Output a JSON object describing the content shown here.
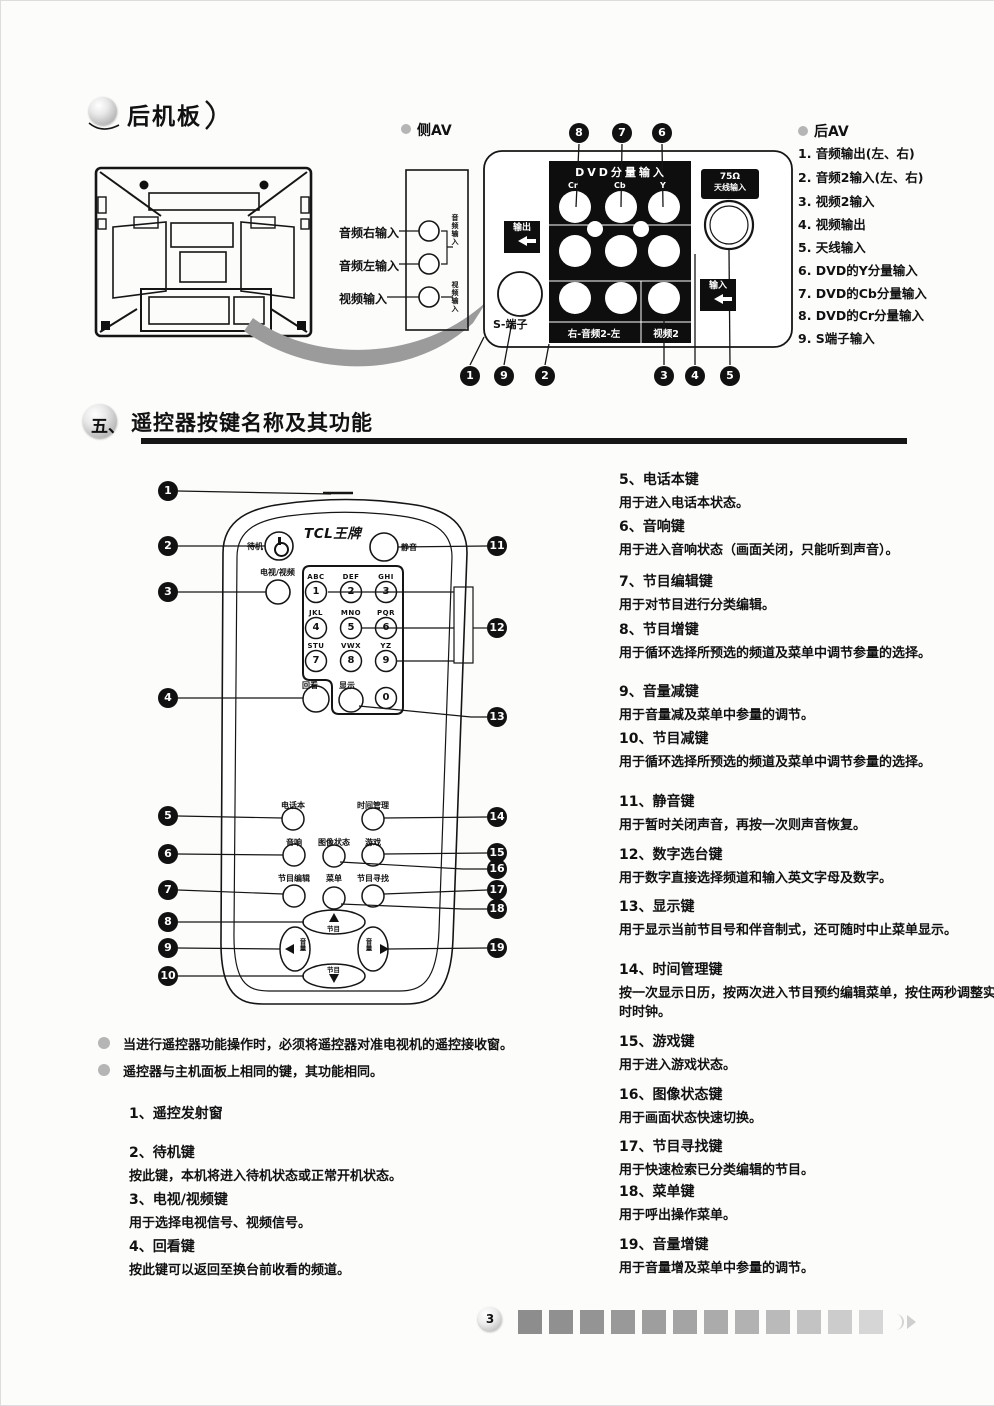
{
  "page": {
    "number": "3"
  },
  "rear": {
    "title": "后机板",
    "side_av_label": "侧AV",
    "side_jacks": [
      "音频右输入",
      "音频左输入",
      "视频输入"
    ],
    "side_vertical": [
      "音频输入",
      "视频输入"
    ],
    "dvd_header": "DVD分量输入",
    "dvd_cols": [
      "Cr",
      "Cb",
      "Y"
    ],
    "out_tag": "输出",
    "in_tag": "输入",
    "ant_tag_line1": "75Ω",
    "ant_tag_line2": "天线输入",
    "s_label": "S-端子",
    "audio2_label": "右-音频2-左",
    "video2_label": "视频2",
    "callouts_top": [
      "8",
      "7",
      "6"
    ],
    "callouts_bottom": [
      "1",
      "9",
      "2",
      "3",
      "4",
      "5"
    ],
    "av_label": "后AV",
    "av_items": [
      "1. 音频输出(左、右)",
      "2. 音频2输入(左、右)",
      "3. 视频2输入",
      "4. 视频输出",
      "5. 天线输入",
      "6. DVD的Y分量输入",
      "7. DVD的Cb分量输入",
      "8. DVD的Cr分量输入",
      "9. S端子输入"
    ]
  },
  "remote": {
    "section_no": "五、",
    "section_title": "遥控器按键名称及其功能",
    "brand": "TCL王牌",
    "power": "待机",
    "mute": "静音",
    "tv_video": "电视/视频",
    "keys": [
      {
        "l": "ABC",
        "d": "1"
      },
      {
        "l": "DEF",
        "d": "2"
      },
      {
        "l": "GHI",
        "d": "3"
      },
      {
        "l": "JKL",
        "d": "4"
      },
      {
        "l": "MNO",
        "d": "5"
      },
      {
        "l": "PQR",
        "d": "6"
      },
      {
        "l": "STU",
        "d": "7"
      },
      {
        "l": "VWX",
        "d": "8"
      },
      {
        "l": "YZ",
        "d": "9"
      }
    ],
    "recall": "回看",
    "display": "显示",
    "zero": "0",
    "btn_phonebook": "电话本",
    "btn_timer": "时间管理",
    "btn_sound": "音响",
    "btn_picture": "图像状态",
    "btn_game": "游戏",
    "btn_edit": "节目编辑",
    "btn_menu": "菜单",
    "btn_search": "节目寻找",
    "dpad_up": "节目",
    "dpad_down": "节目",
    "dpad_left": "音量",
    "dpad_right": "音量",
    "callouts_left": [
      "1",
      "2",
      "3",
      "4",
      "5",
      "6",
      "7",
      "8",
      "9",
      "10"
    ],
    "callouts_right": [
      "11",
      "12",
      "13",
      "14",
      "15",
      "16",
      "17",
      "18",
      "19"
    ]
  },
  "notes": [
    "当进行遥控器功能操作时，必须将遥控器对准电视机的遥控接收窗。",
    "遥控器与主机面板上相同的键，其功能相同。"
  ],
  "items_left": [
    {
      "title": "1、遥控发射窗",
      "desc": ""
    },
    {
      "title": "2、待机键",
      "desc": "按此键，本机将进入待机状态或正常开机状态。"
    },
    {
      "title": "3、电视/视频键",
      "desc": "用于选择电视信号、视频信号。"
    },
    {
      "title": "4、回看键",
      "desc": "按此键可以返回至换台前收看的频道。"
    }
  ],
  "items_right": [
    {
      "title": "5、电话本键",
      "desc": "用于进入电话本状态。"
    },
    {
      "title": "6、音响键",
      "desc": "用于进入音响状态（画面关闭，只能听到声音）。"
    },
    {
      "title": "7、节目编辑键",
      "desc": "用于对节目进行分类编辑。"
    },
    {
      "title": "8、节目增键",
      "desc": "用于循环选择所预选的频道及菜单中调节参量的选择。"
    },
    {
      "title": "9、音量减键",
      "desc": "用于音量减及菜单中参量的调节。"
    },
    {
      "title": "10、节目减键",
      "desc": "用于循环选择所预选的频道及菜单中调节参量的选择。"
    },
    {
      "title": "11、静音键",
      "desc": "用于暂时关闭声音，再按一次则声音恢复。"
    },
    {
      "title": "12、数字选台键",
      "desc": "用于数字直接选择频道和输入英文字母及数字。"
    },
    {
      "title": "13、显示键",
      "desc": "用于显示当前节目号和伴音制式，还可随时中止菜单显示。"
    },
    {
      "title": "14、时间管理键",
      "desc": "按一次显示日历，按两次进入节目预约编辑菜单，按住两秒调整实时时钟。"
    },
    {
      "title": "15、游戏键",
      "desc": "用于进入游戏状态。"
    },
    {
      "title": "16、图像状态键",
      "desc": "用于画面状态快速切换。"
    },
    {
      "title": "17、节目寻找键",
      "desc": "用于快速检索已分类编辑的节目。"
    },
    {
      "title": "18、菜单键",
      "desc": "用于呼出操作菜单。"
    },
    {
      "title": "19、音量增键",
      "desc": "用于音量增及菜单中参量的调节。"
    }
  ]
}
